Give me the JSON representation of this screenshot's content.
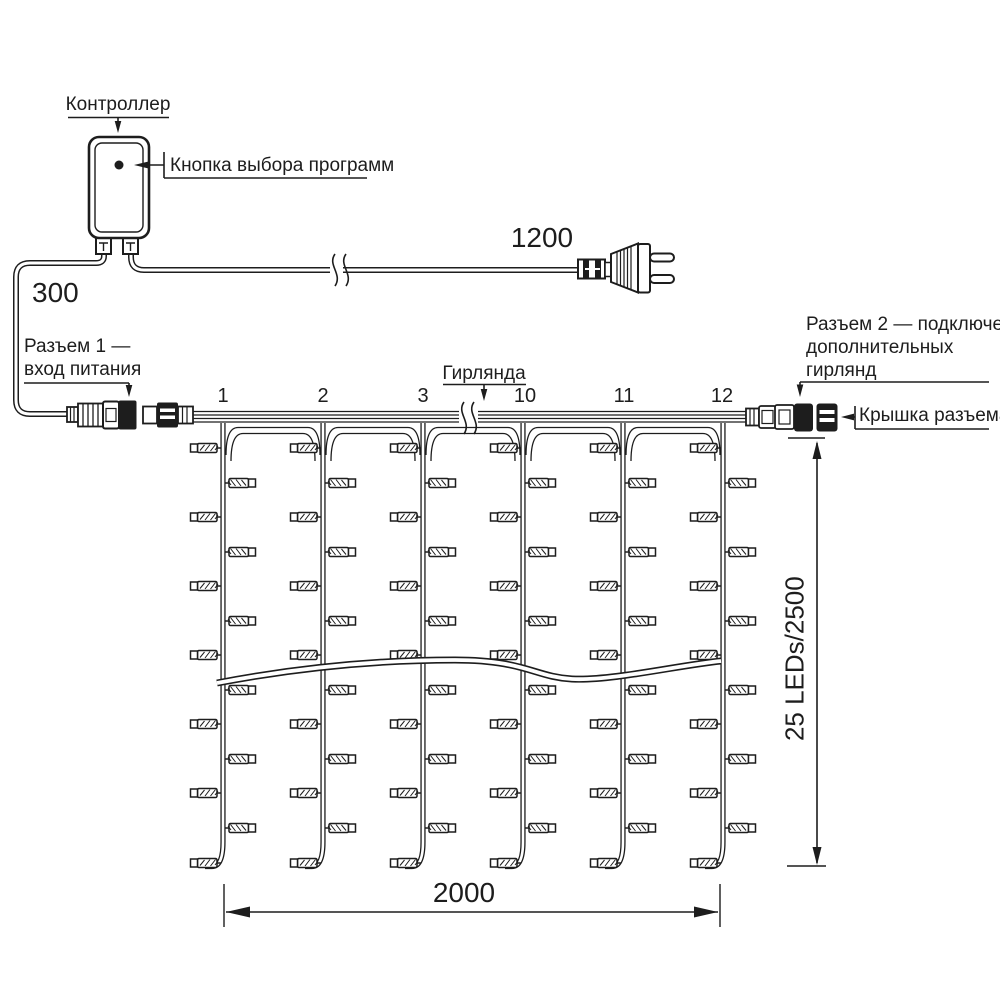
{
  "diagram": {
    "controller": {
      "label": "Контроллер",
      "button_label": "Кнопка выбора программ"
    },
    "cables": {
      "input_cable_length": "300",
      "plug_cable_length": "1200"
    },
    "connector1": {
      "label_line1": "Разъем 1 —",
      "label_line2": "вход питания"
    },
    "connector2": {
      "label_line1": "Разъем 2 — подключение",
      "label_line2": "дополнительных",
      "label_line3": "гирлянд",
      "cap_label": "Крышка разъема"
    },
    "curtain": {
      "label": "Гирлянда",
      "string_numbers": [
        "1",
        "2",
        "3",
        "10",
        "11",
        "12"
      ],
      "width_dimension": "2000",
      "height_dimension": "25 LEDs/2500"
    }
  },
  "colors": {
    "line": "#1d1d1d",
    "background": "#ffffff"
  }
}
